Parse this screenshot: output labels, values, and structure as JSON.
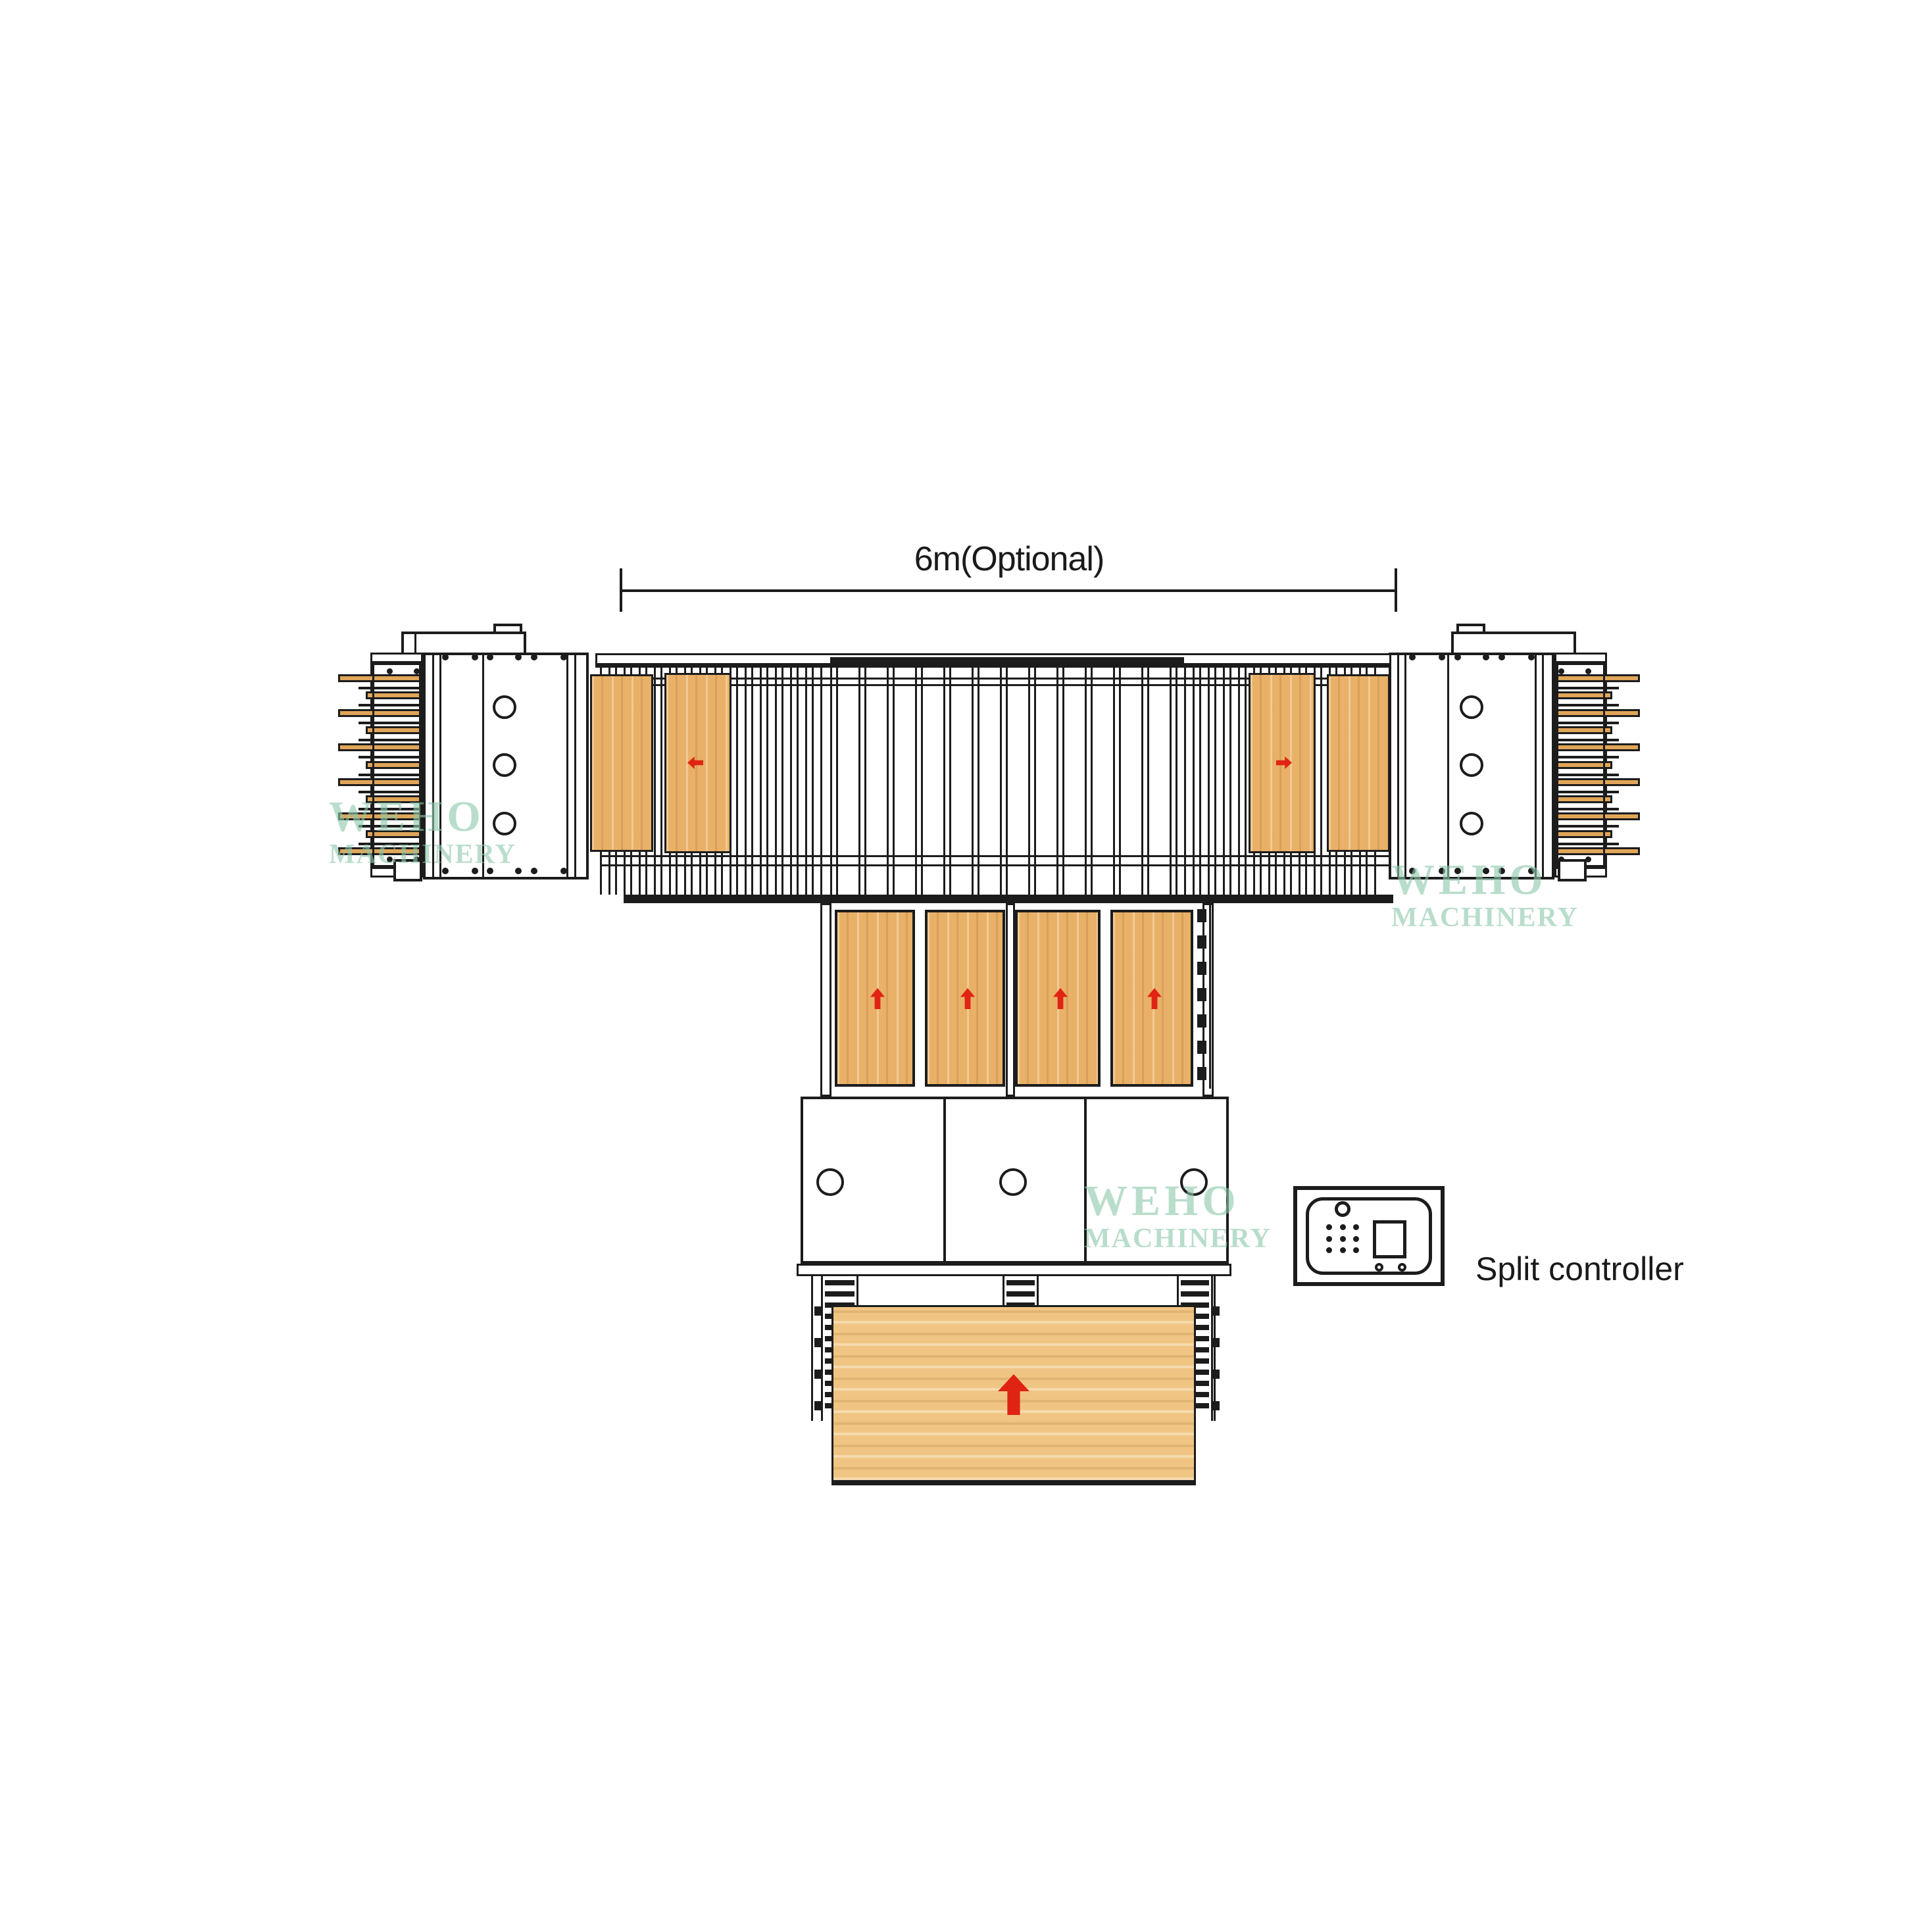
{
  "dimension": {
    "label": "6m(Optional)"
  },
  "controller": {
    "label": "Split controller"
  },
  "watermark": {
    "line1": "WEHO",
    "line2": "MACHINERY"
  },
  "colors": {
    "line": "#1c1c1c",
    "text": "#1a1a1a",
    "wood": "#e9b067",
    "wood_light": "#f0c583",
    "comb_wood": "#dfa659",
    "arrow_red": "#e02414",
    "watermark_green": "#8fc9ac"
  },
  "figure": {
    "type": "machinery-layout-diagram",
    "press_circle_count": 3,
    "box_circle_count": 3,
    "comb_teeth_count": 11,
    "infeed_panel_count": 4,
    "ladder_count": 3,
    "chain_dash_count": 7,
    "keypad_rows": 3,
    "keypad_cols": 3,
    "flow_arrows": [
      "left",
      "right",
      "up",
      "up",
      "up",
      "up",
      "up"
    ]
  }
}
